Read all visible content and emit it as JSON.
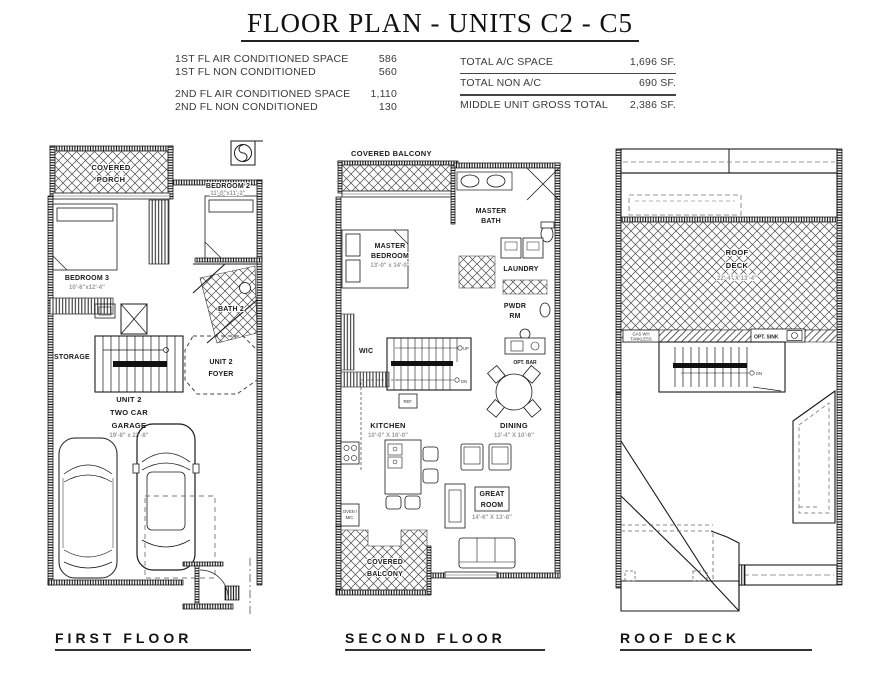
{
  "header": {
    "title": "FLOOR PLAN - UNITS C2 - C5"
  },
  "stats": {
    "left": [
      {
        "label": "1ST FL AIR CONDITIONED SPACE",
        "value": "586"
      },
      {
        "label": "1ST FL NON CONDITIONED",
        "value": "560"
      },
      {
        "label": "2ND FL AIR CONDITIONED SPACE",
        "value": "1,110"
      },
      {
        "label": "2ND FL NON CONDITIONED",
        "value": "130"
      }
    ],
    "right": [
      {
        "label": "TOTAL A/C SPACE",
        "value": "1,696 SF."
      },
      {
        "label": "TOTAL NON A/C",
        "value": "690 SF."
      },
      {
        "label": "MIDDLE UNIT GROSS TOTAL",
        "value": "2,386 SF."
      }
    ]
  },
  "first_floor": {
    "title": "FIRST FLOOR",
    "covered_porch": [
      "COVERED",
      "PORCH"
    ],
    "bedroom2": {
      "name": "BEDROOM 2",
      "dims": "11'-0\"x11'-2\""
    },
    "bedroom3": {
      "name": "BEDROOM 3",
      "dims": "10'-8\"x12'-4\""
    },
    "bath2": "BATH 2",
    "storage": "STORAGE",
    "foyer": [
      "UNIT 2",
      "FOYER"
    ],
    "garage": {
      "lines": [
        "UNIT 2",
        "TWO CAR",
        "GARAGE"
      ],
      "dims": "19'-8\" x 22'-8\""
    }
  },
  "second_floor": {
    "title": "SECOND FLOOR",
    "covered_balcony_top": "COVERED BALCONY",
    "master_bath": [
      "MASTER",
      "BATH"
    ],
    "master_bedroom": {
      "lines": [
        "MASTER",
        "BEDROOM"
      ],
      "dims": "13'-0\" x 14'-0\""
    },
    "laundry": "LAUNDRY",
    "pwdr": [
      "PWDR",
      "RM"
    ],
    "wic": "WIC",
    "opt_bar": "OPT. BAR",
    "ref": "REF.",
    "oven_mic": [
      "OVEN /",
      "MIC."
    ],
    "up": "UP",
    "dn": "DN",
    "kitchen": {
      "name": "KITCHEN",
      "dims": "10'-0\" X 16'-0\""
    },
    "dining": {
      "name": "DINING",
      "dims": "13'-4\" X 10'-6\""
    },
    "great_room": {
      "lines": [
        "GREAT",
        "ROOM"
      ],
      "dims": "14'-6\" X 13'-8\""
    },
    "covered_balcony_bottom": [
      "COVERED",
      "BALCONY"
    ]
  },
  "roof_deck": {
    "title": "ROOF DECK",
    "deck": {
      "lines": [
        "ROOF",
        "DECK"
      ],
      "dims": "22'-4\" X 13'-4\""
    },
    "gas_wh": [
      "GAS WH",
      "TANKLESS"
    ],
    "opt_sink": "OPT. SINK",
    "dn": "DN"
  }
}
